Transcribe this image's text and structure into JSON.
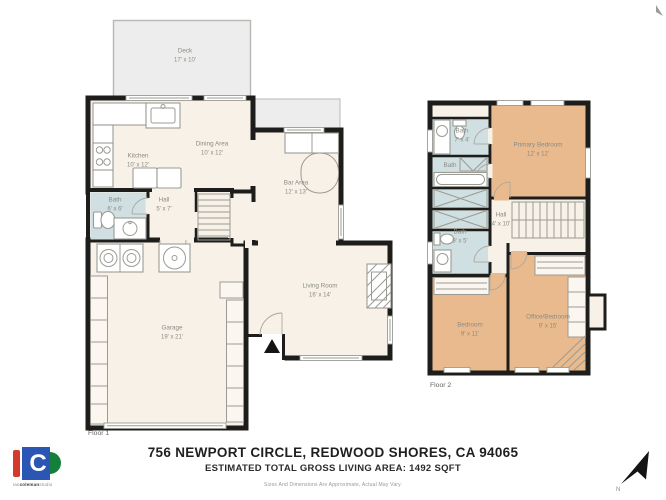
{
  "meta": {
    "title": "756 NEWPORT CIRCLE, REDWOOD SHORES, CA 94065",
    "subtitle": "ESTIMATED TOTAL GROSS LIVING AREA: 1492 SQFT",
    "disclaimer": "Sizes And Dimensions Are Approximate, Actual May Vary."
  },
  "logo": {
    "letter": "C",
    "text_light1": "ian",
    "text_bold": "coleman",
    "text_light2": "studio"
  },
  "compass": {
    "label": "N"
  },
  "floor1": {
    "caption": "Floor 1",
    "rooms": {
      "deck": {
        "name": "Deck",
        "dims": "17' x 10'"
      },
      "kitchen": {
        "name": "Kitchen",
        "dims": "10' x 12'"
      },
      "dining": {
        "name": "Dining Area",
        "dims": "10' x 12'"
      },
      "bar": {
        "name": "Bar Area",
        "dims": "12' x 13'"
      },
      "bath": {
        "name": "Bath",
        "dims": "6' x 6'"
      },
      "hall": {
        "name": "Hall",
        "dims": "5' x 7'"
      },
      "living": {
        "name": "Living Room",
        "dims": "16' x 14'"
      },
      "garage": {
        "name": "Garage",
        "dims": "19' x 21'"
      }
    }
  },
  "floor2": {
    "caption": "Floor 2",
    "rooms": {
      "bath_top": {
        "name": "Bath",
        "dims": "7' x 4'"
      },
      "primary": {
        "name": "Primary Bedroom",
        "dims": "12' x 12'"
      },
      "bath_mid": {
        "name": "Bath",
        "dims": ""
      },
      "bath_lower": {
        "name": "Bath",
        "dims": "9' x 5'"
      },
      "hall": {
        "name": "Hall",
        "dims": "4' x 10'"
      },
      "bedroom": {
        "name": "Bedroom",
        "dims": "9' x 11'"
      },
      "office": {
        "name": "Office/Bedroom",
        "dims": "9' x 15'"
      }
    }
  },
  "colors": {
    "wall": "#1d1d1b",
    "floor": "#f7f1e8",
    "bath": "#cfdfe2",
    "bedroom": "#e9ba8e",
    "deck": "#ededed",
    "fixture": "#9b9b94",
    "label": "#8b8b83",
    "logo_red": "#d5382c",
    "logo_blue": "#2b56b4",
    "logo_green": "#15803c"
  }
}
